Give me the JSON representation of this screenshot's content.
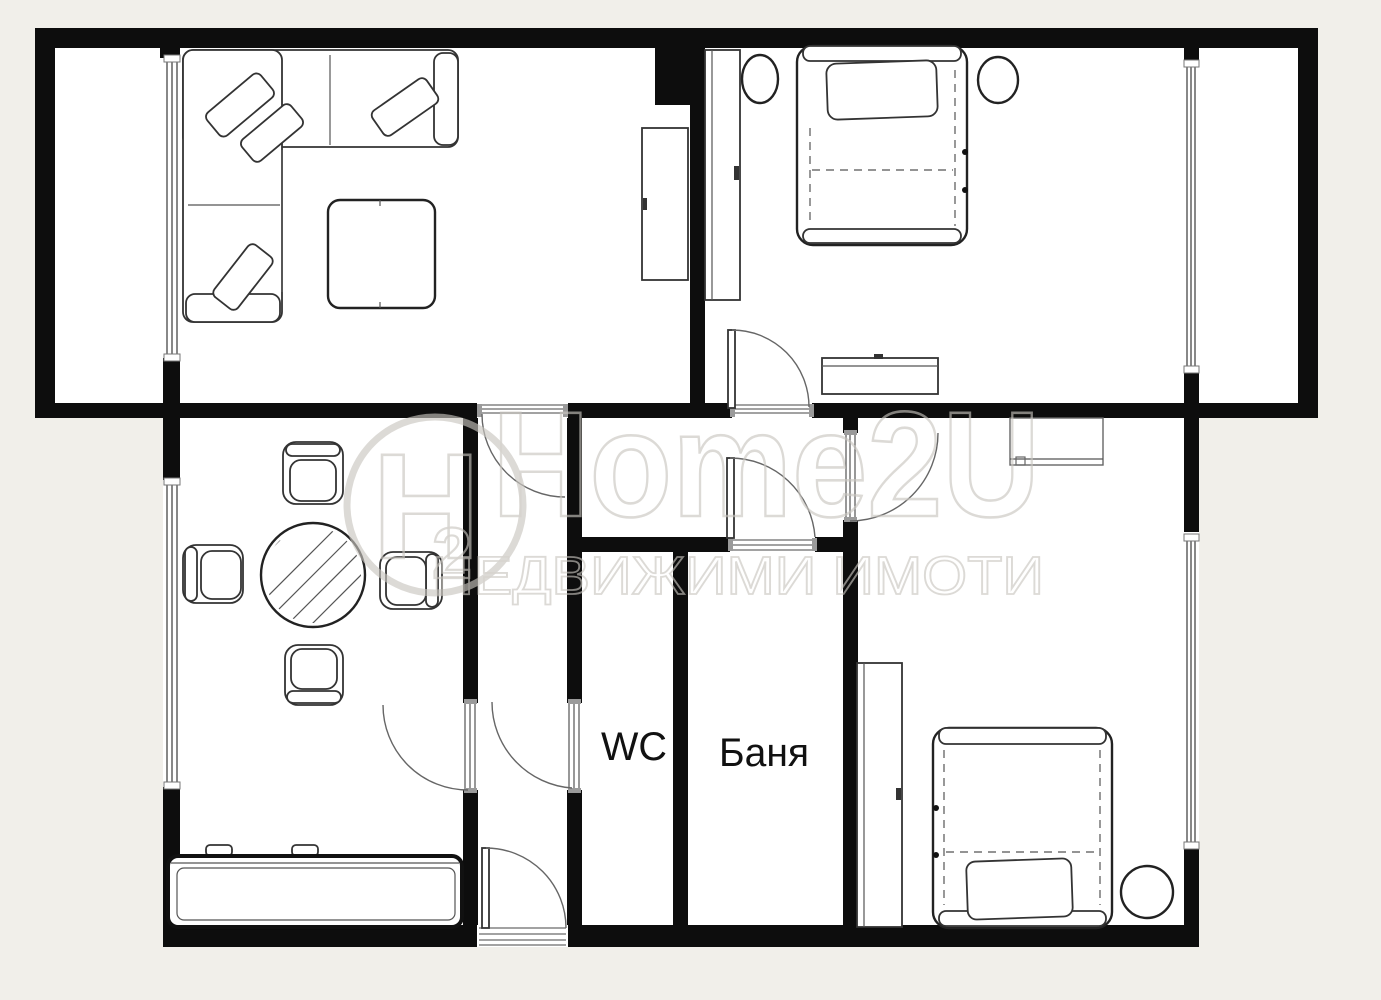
{
  "title": "Apartment floor plan",
  "labels": {
    "wc": "WC",
    "bath": "Баня"
  },
  "watermark": {
    "brand": "Home2U",
    "tagline": "НЕДВИЖИМИ ИМОТИ",
    "logo_letter": "H",
    "logo_digit": "2"
  },
  "colors": {
    "background": "#f1efea",
    "room_fill": "#ffffff",
    "wall": "#0d0d0d",
    "watermark": "#c9c6bf"
  }
}
